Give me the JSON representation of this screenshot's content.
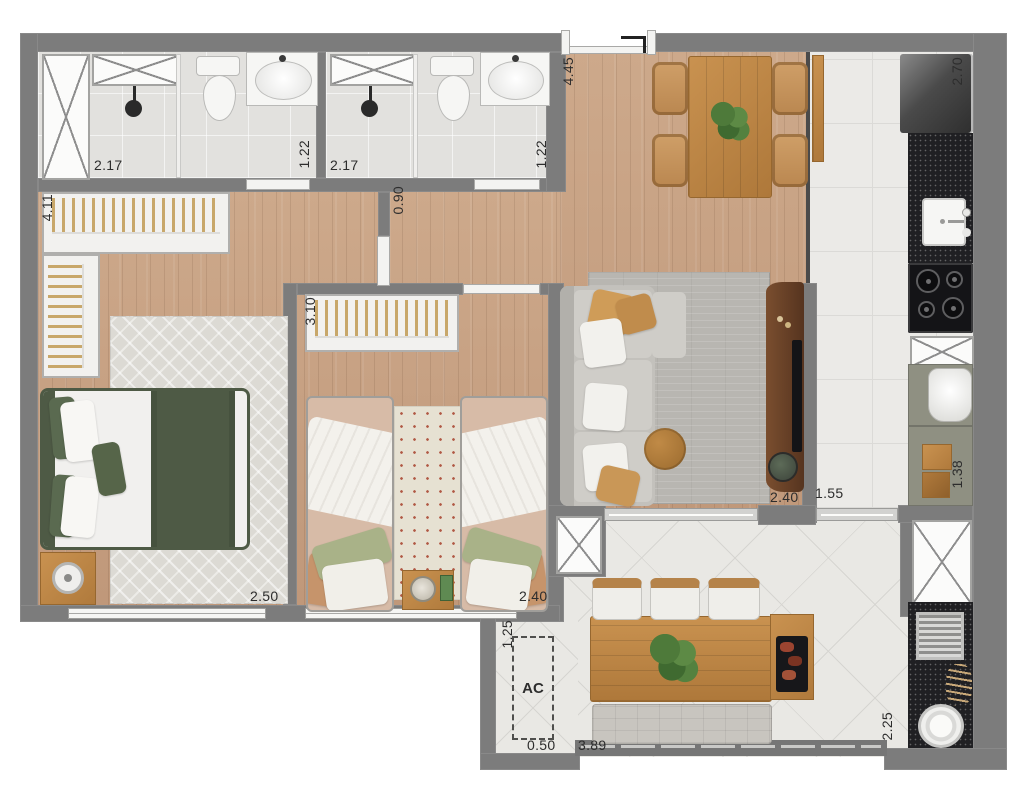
{
  "dims": {
    "master_closet": "4.11",
    "bath1_width": "2.17",
    "bath1_depth": "1.22",
    "bath2_width": "2.17",
    "bath2_depth": "1.22",
    "hall_width": "0.90",
    "social_length": "4.45",
    "kitchen_length": "2.70",
    "bed2_closet": "3.10",
    "master_width": "2.50",
    "bed2_width": "2.40",
    "living_door": "2.40",
    "kitchen_door": "1.55",
    "kitchen_cabinet": "1.38",
    "balcony_depth": "2.25",
    "ac_depth": "1.25",
    "ac_width": "0.50",
    "balcony_width": "3.89"
  },
  "labels": {
    "ac": "AC"
  },
  "colors": {
    "wall": "#7c7c7c",
    "wood_floor": "#c7a083",
    "kitchen_tile": "#ebeae7",
    "bath_tile": "#e2e1de",
    "balcony_tile": "#e9e8e4",
    "bed_green": "#4e5a45",
    "counter_black": "#202023",
    "furniture_wood": "#c08848",
    "sofa_gray": "#c3c1bc"
  }
}
